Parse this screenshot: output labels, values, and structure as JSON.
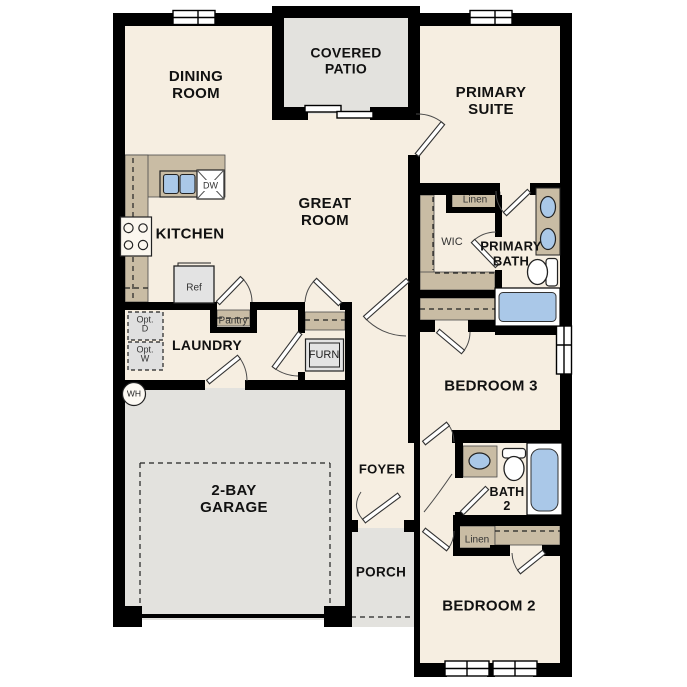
{
  "plan": {
    "type": "residential-floor-plan",
    "labels": {
      "dining_room": "DINING\nROOM",
      "covered_patio": "COVERED\nPATIO",
      "primary_suite": "PRIMARY\nSUITE",
      "kitchen": "KITCHEN",
      "great_room": "GREAT\nROOM",
      "wic": "WIC",
      "linen_primary": "Linen",
      "primary_bath": "PRIMARY\nBATH",
      "laundry": "LAUNDRY",
      "pantry": "Pantry",
      "furnace": "FURN",
      "opt_dryer": "Opt.\nD",
      "opt_washer": "Opt.\nW",
      "water_heater": "WH",
      "garage": "2-BAY\nGARAGE",
      "bedroom_3": "BEDROOM 3",
      "foyer": "FOYER",
      "bath_2": "BATH\n2",
      "linen_bath2": "Linen",
      "porch": "PORCH",
      "bedroom_2": "BEDROOM 2",
      "dishwasher": "DW",
      "refrigerator": "Ref"
    },
    "colors": {
      "walls": "#000000",
      "interior_floor": "#f6eee1",
      "outdoor_concrete": "#e3e2de",
      "casework_tan": "#c9bca4",
      "fixture_blue": "#aac8e8",
      "appliance_gray": "#e3e3e3",
      "background": "#ffffff"
    }
  }
}
